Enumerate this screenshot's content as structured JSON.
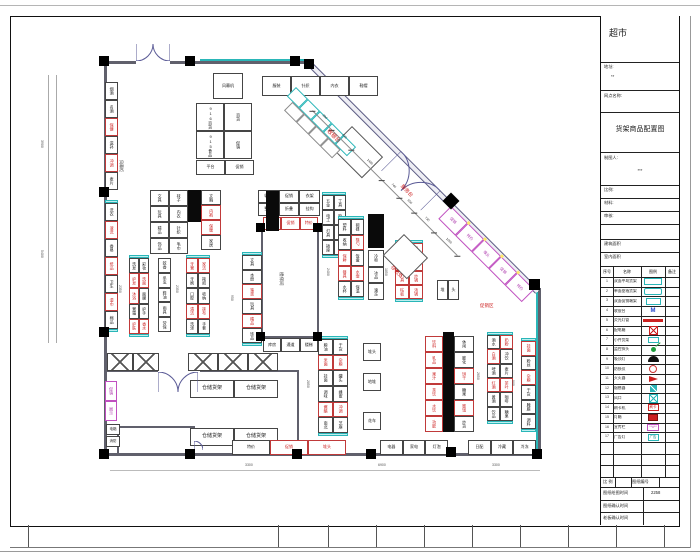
{
  "sheet": {
    "frame": {
      "strip_ticks": [
        28,
        278,
        328,
        376,
        424,
        472,
        520,
        568,
        616,
        664
      ]
    },
    "titleblock": {
      "store_name": "超市",
      "addr_label": "地址:",
      "addr_value": "**",
      "branch_label": "网点名称:",
      "drawing_title": "货架商品配置图",
      "drafter_label": "制图人:",
      "drafter_value": "***",
      "scale_label": "比例:",
      "material_label": "材料:",
      "audit_label": "审核:",
      "area1_label": "建筑面积",
      "area2_label": "室内面积",
      "legend_headers": [
        "序号",
        "名称",
        "图例",
        "备注"
      ],
      "legend_rows": [
        {
          "no": "1",
          "name": "双面中岛货架",
          "sym": "shelf-cyan"
        },
        {
          "no": "2",
          "name": "单面靠墙货架",
          "sym": "shelf-cyan2"
        },
        {
          "no": "3",
          "name": "双面促销端架",
          "sym": "shelf-cyan3"
        },
        {
          "no": "4",
          "name": "收银台",
          "sym": "m-blue",
          "symText": "M"
        },
        {
          "no": "5",
          "name": "荧光灯管",
          "sym": "bar-red"
        },
        {
          "no": "6",
          "name": "配电箱",
          "sym": "box-redx"
        },
        {
          "no": "7",
          "name": "小件货架",
          "sym": "cyan-small"
        },
        {
          "no": "8",
          "name": "监控探头",
          "sym": "green-dot"
        },
        {
          "no": "9",
          "name": "吸顶灯",
          "sym": "black-dome"
        },
        {
          "no": "10",
          "name": "防损仪",
          "sym": "red-ring"
        },
        {
          "no": "11",
          "name": "灭火器",
          "sym": "red-flag"
        },
        {
          "no": "12",
          "name": "烟感器",
          "sym": "teal-box"
        },
        {
          "no": "13",
          "name": "风口",
          "sym": "cyan-x"
        },
        {
          "no": "14",
          "name": "刷卡机",
          "sym": "red-textbox",
          "symText": "刷卡"
        },
        {
          "no": "15",
          "name": "灯箱",
          "sym": "red-fill"
        },
        {
          "no": "16",
          "name": "宣传栏",
          "sym": "magenta-box",
          "symText": "**#**"
        },
        {
          "no": "17",
          "name": "广告灯",
          "sym": "cyan-textbox",
          "symText": "广告"
        },
        {
          "no": "",
          "name": "",
          "sym": ""
        },
        {
          "no": "",
          "name": "",
          "sym": ""
        },
        {
          "no": "",
          "name": "",
          "sym": ""
        }
      ],
      "bottom_rows": {
        "r1a": "比 例",
        "r1b": "图纸编号",
        "r2_label": "图纸绘图时间",
        "r2_value": "2258",
        "r3_label": "图纸确认时间",
        "r4_label": "老板确认时间"
      }
    }
  },
  "plan": {
    "walls": [
      {
        "x": 104,
        "y": 61,
        "w": 32,
        "h": 3
      },
      {
        "x": 170,
        "y": 61,
        "w": 142,
        "h": 3
      },
      {
        "x": 200,
        "y": 59,
        "w": 112,
        "h": 2,
        "c": "#2ab6b8",
        "n": "wall-shelf-line"
      },
      {
        "x": 104,
        "y": 61,
        "w": 3,
        "h": 395
      },
      {
        "x": 104,
        "y": 453,
        "w": 437,
        "h": 3
      },
      {
        "x": 538,
        "y": 288,
        "w": 3,
        "h": 168
      },
      {
        "x": 536,
        "y": 292,
        "w": 2,
        "h": 162,
        "c": "#2ab6b8",
        "n": "wall-shelf-line"
      },
      {
        "x": 104,
        "y": 370,
        "w": 54,
        "h": 2,
        "n": "storage-wall"
      },
      {
        "x": 200,
        "y": 370,
        "w": 99,
        "h": 2,
        "n": "storage-wall"
      },
      {
        "x": 297,
        "y": 370,
        "w": 2,
        "h": 86,
        "n": "storage-wall"
      },
      {
        "x": 117,
        "y": 426,
        "w": 78,
        "h": 2,
        "n": "room-wall"
      },
      {
        "x": 117,
        "y": 426,
        "w": 2,
        "h": 30,
        "n": "room-wall"
      },
      {
        "x": 193,
        "y": 426,
        "w": 2,
        "h": 10,
        "n": "room-wall"
      },
      {
        "x": 261,
        "y": 228,
        "w": 58,
        "h": 2,
        "n": "stair-core-wall"
      },
      {
        "x": 261,
        "y": 228,
        "w": 2,
        "h": 110,
        "n": "stair-core-wall"
      },
      {
        "x": 317,
        "y": 228,
        "w": 2,
        "h": 110,
        "n": "stair-core-wall"
      },
      {
        "x": 261,
        "y": 336,
        "w": 58,
        "h": 2,
        "n": "stair-core-wall"
      },
      {
        "x": 48,
        "y": 75,
        "w": 1,
        "h": 268,
        "c": "#aaa",
        "n": "dim-ext-line"
      },
      {
        "x": 56,
        "y": 75,
        "w": 1,
        "h": 268,
        "c": "#aaa",
        "n": "dim-ext-line"
      },
      {
        "x": 110,
        "y": 470,
        "w": 430,
        "h": 1,
        "c": "#bbb",
        "n": "dim-ext-line"
      }
    ],
    "black_blocks": [
      {
        "x": 266,
        "y": 191,
        "w": 13,
        "h": 40
      },
      {
        "x": 188,
        "y": 190,
        "w": 13,
        "h": 32
      },
      {
        "x": 368,
        "y": 214,
        "w": 16,
        "h": 34
      },
      {
        "x": 443,
        "y": 332,
        "w": 11,
        "h": 100
      }
    ],
    "columns": [
      {
        "x": 99,
        "y": 56
      },
      {
        "x": 185,
        "y": 56
      },
      {
        "x": 290,
        "y": 56
      },
      {
        "x": 304,
        "y": 59
      },
      {
        "x": 99,
        "y": 187
      },
      {
        "x": 99,
        "y": 327
      },
      {
        "x": 99,
        "y": 449
      },
      {
        "x": 185,
        "y": 449
      },
      {
        "x": 292,
        "y": 449
      },
      {
        "x": 366,
        "y": 449
      },
      {
        "x": 446,
        "y": 447
      },
      {
        "x": 532,
        "y": 449
      },
      {
        "x": 256,
        "y": 223,
        "s": 9
      },
      {
        "x": 313,
        "y": 223,
        "s": 9
      },
      {
        "x": 256,
        "y": 332,
        "s": 9
      },
      {
        "x": 313,
        "y": 332,
        "s": 9
      },
      {
        "x": 445,
        "y": 195,
        "s": 12,
        "r": 1
      },
      {
        "x": 529,
        "y": 279,
        "s": 11
      }
    ],
    "doors": [
      {
        "x": 136,
        "y": 44,
        "w": 34,
        "dir": "up"
      },
      {
        "x": 401,
        "y": 151,
        "w": 56,
        "dir": "down",
        "rot": 45
      },
      {
        "x": 158,
        "y": 372,
        "w": 40,
        "dir": "down"
      },
      {
        "x": 194,
        "y": 437,
        "w": 18,
        "dir": "single"
      }
    ],
    "diamonds": [
      {
        "x": 352,
        "y": 126,
        "w": 44,
        "h": 30
      },
      {
        "x": 404,
        "y": 234,
        "w": 34,
        "h": 30
      }
    ],
    "diag_wall": {
      "x": 309,
      "y": 59,
      "len": 326,
      "rot": 45
    },
    "checkout": {
      "x": 296,
      "y": 87,
      "rot": 45
    },
    "magenta_run": {
      "x": 451,
      "y": 206,
      "rot": 45,
      "labels": "促销|特价|堆头|促销|特价"
    },
    "dim_line": {
      "x": 317,
      "y": 106,
      "rot": 45,
      "len": 205,
      "numbers": "890|940|1480|740|650|730|1060"
    },
    "x_units": [
      {
        "x": 107,
        "y": 353,
        "w": 52,
        "h": 18,
        "cols": 2
      },
      {
        "x": 188,
        "y": 353,
        "w": 90,
        "h": 18,
        "cols": 3
      }
    ],
    "gondolas": [
      {
        "n": "entrance-air-curtain",
        "x": 213,
        "y": 73,
        "w": 30,
        "h": 26,
        "cols": 1,
        "rows": 1,
        "labels": "风幕机",
        "fs": 4,
        "dir": "h"
      },
      {
        "n": "wall-shelf-front",
        "x": 262,
        "y": 76,
        "w": 116,
        "h": 20,
        "cols": 4,
        "rows": 1,
        "dir": "h",
        "labels": "服装|针织|内衣|鞋帽"
      },
      {
        "n": "promo-block",
        "x": 196,
        "y": 103,
        "w": 56,
        "h": 56,
        "cols": 2,
        "rows": 2,
        "labels": "916百货|915食品|百货|促销"
      },
      {
        "n": "promo-platform",
        "x": 196,
        "y": 160,
        "w": 58,
        "h": 15,
        "cols": 2,
        "rows": 1,
        "dir": "h",
        "labels": "平台|促销"
      },
      {
        "n": "wall-shelf-left",
        "x": 105,
        "y": 82,
        "w": 13,
        "h": 108,
        "cols": 1,
        "rows": 6,
        "labels": "烟酒|名酒|保健|滋补|冲调|麦片",
        "red": [
          2,
          4
        ]
      },
      {
        "n": "wall-shelf-left",
        "x": 105,
        "y": 200,
        "w": 13,
        "h": 132,
        "cols": 1,
        "rows": 7,
        "cap": true,
        "labels": "洗衣|液洗|香皂|纸品|卫生|湿巾|棉品",
        "red": [
          1,
          3,
          5
        ]
      },
      {
        "n": "gondola",
        "x": 150,
        "y": 190,
        "w": 38,
        "h": 64,
        "cols": 2,
        "rows": 4,
        "labels": "文具|玩具|精品|饰品|袜子|内衣|针织|毛巾"
      },
      {
        "n": "gondola",
        "x": 201,
        "y": 190,
        "w": 20,
        "h": 60,
        "cols": 1,
        "rows": 4,
        "labels": "文胸|内裤|保暖|家居",
        "red": [
          1,
          2
        ]
      },
      {
        "n": "gondola",
        "x": 129,
        "y": 255,
        "w": 20,
        "h": 82,
        "cols": 2,
        "rows": 5,
        "cap": true,
        "labels": "洗发|护发|沐浴|膏霜|护肤|彩妆|洗面|面膜|护手|香水",
        "red": [
          1,
          2,
          4,
          6,
          9
        ]
      },
      {
        "n": "gondola",
        "x": 158,
        "y": 258,
        "w": 13,
        "h": 74,
        "cols": 1,
        "rows": 5,
        "labels": "蚊香|杀虫|鞋油|雨具|劳保"
      },
      {
        "n": "gondola",
        "x": 186,
        "y": 255,
        "w": 24,
        "h": 82,
        "cols": 2,
        "rows": 5,
        "cap": true,
        "labels": "牙膏|牙刷|口腔|清洁|洗涤|家洁|拖把|收纳|抹布|手套",
        "red": [
          0,
          3,
          5,
          8
        ]
      },
      {
        "n": "gondola",
        "x": 242,
        "y": 252,
        "w": 20,
        "h": 94,
        "cols": 1,
        "rows": 6,
        "cap": true,
        "labels": "文具|本册|笔类|玩具|精品|饰品",
        "red": [
          2,
          4
        ]
      },
      {
        "n": "end-cap-shelf",
        "x": 263,
        "y": 217,
        "w": 55,
        "h": 13,
        "cols": 3,
        "rows": 1,
        "dir": "h",
        "labels": "端架|促销|特价",
        "red": [
          0,
          1,
          2
        ]
      },
      {
        "n": "gondola",
        "x": 258,
        "y": 190,
        "w": 62,
        "h": 26,
        "cols": 3,
        "rows": 2,
        "dir": "h",
        "labels": "收纳|整理|促销|折叠|衣架|挂钩"
      },
      {
        "n": "end-cap-shelf",
        "x": 263,
        "y": 338,
        "w": 55,
        "h": 14,
        "cols": 3,
        "rows": 1,
        "dir": "h",
        "labels": "库房|通道|楼梯"
      },
      {
        "n": "gondola",
        "x": 322,
        "y": 192,
        "w": 24,
        "h": 66,
        "cols": 2,
        "rows": 4,
        "cap": true,
        "labels": "五金|电工|灯具|插座|工具|胶带|电池|线材"
      },
      {
        "n": "gondola",
        "x": 338,
        "y": 216,
        "w": 26,
        "h": 84,
        "cols": 2,
        "rows": 5,
        "cap": true,
        "labels": "塑料|收纳|保鲜|餐具|水杯|碗碟|筷勺|饭盒|水壶|保温",
        "red": [
          2,
          3,
          6,
          8
        ]
      },
      {
        "n": "freezer-run",
        "x": 368,
        "y": 250,
        "w": 16,
        "h": 50,
        "cols": 1,
        "rows": 3,
        "labels": "冷柜|冰品|速冻"
      },
      {
        "n": "gondola",
        "x": 395,
        "y": 240,
        "w": 28,
        "h": 62,
        "cols": 2,
        "rows": 4,
        "cap": true,
        "labels": "锅具|厨杂|刀具|砧板|炊具|蒸锅|炒锅|汤锅",
        "red": [
          0,
          1,
          2,
          3,
          4,
          5,
          6,
          7
        ]
      },
      {
        "n": "promo-table",
        "x": 437,
        "y": 280,
        "w": 22,
        "h": 20,
        "cols": 2,
        "rows": 1,
        "dir": "h",
        "labels": "堆|头"
      },
      {
        "n": "gondola",
        "x": 318,
        "y": 336,
        "w": 30,
        "h": 100,
        "cols": 2,
        "rows": 6,
        "cap": true,
        "labels": "粮油|米面|挂面|调味|酱醋|南北|干货|杂粮|罐头|蜂蜜|冲调|芝麻",
        "red": [
          1,
          4,
          7,
          10
        ]
      },
      {
        "n": "gondola",
        "x": 425,
        "y": 336,
        "w": 18,
        "h": 96,
        "cols": 1,
        "rows": 6,
        "labels": "饮料|乳品|果汁|茶饮|水饮|功能",
        "red": [
          0,
          1,
          2,
          3,
          4,
          5
        ]
      },
      {
        "n": "gondola",
        "x": 454,
        "y": 336,
        "w": 20,
        "h": 96,
        "cols": 1,
        "rows": 6,
        "labels": "休闲|膨化|饼干|糖果|蜜饯|炒货",
        "red": [
          2,
          4
        ]
      },
      {
        "n": "gondola",
        "x": 487,
        "y": 332,
        "w": 26,
        "h": 92,
        "cols": 2,
        "rows": 6,
        "cap": true,
        "labels": "酒水|白酒|啤酒|红酒|黄酒|饮品|奶粉|冲饮|麦片|茶叶|咖啡|糖果",
        "red": [
          1,
          3,
          6,
          9
        ]
      },
      {
        "n": "wall-shelf-right",
        "x": 521,
        "y": 338,
        "w": 15,
        "h": 94,
        "cols": 1,
        "rows": 6,
        "cap": true,
        "labels": "挂面|粉丝|杂粮|干货|腌腊|调料",
        "red": [
          0,
          2
        ]
      },
      {
        "n": "promo-table",
        "x": 363,
        "y": 343,
        "w": 18,
        "h": 18,
        "cols": 1,
        "rows": 1,
        "dir": "h",
        "labels": "堆头"
      },
      {
        "n": "promo-table",
        "x": 363,
        "y": 373,
        "w": 18,
        "h": 18,
        "cols": 1,
        "rows": 1,
        "dir": "h",
        "labels": "地堆"
      },
      {
        "n": "promo-table",
        "x": 363,
        "y": 412,
        "w": 18,
        "h": 18,
        "cols": 1,
        "rows": 1,
        "dir": "h",
        "labels": "花车"
      },
      {
        "n": "storage-rack",
        "x": 190,
        "y": 380,
        "w": 88,
        "h": 18,
        "cols": 2,
        "rows": 1,
        "dir": "h",
        "labels": "仓储货架|仓储货架",
        "fs": 5
      },
      {
        "n": "storage-rack",
        "x": 190,
        "y": 428,
        "w": 88,
        "h": 18,
        "cols": 2,
        "rows": 1,
        "dir": "h",
        "labels": "仓储货架|仓储货架",
        "fs": 5
      },
      {
        "n": "wall-shelf-bottom",
        "x": 232,
        "y": 440,
        "w": 114,
        "h": 15,
        "cols": 3,
        "rows": 1,
        "dir": "h",
        "labels": "特价|促销|堆头",
        "red": [
          1,
          2
        ]
      },
      {
        "n": "wall-shelf-bottom",
        "x": 380,
        "y": 440,
        "w": 68,
        "h": 15,
        "cols": 3,
        "rows": 1,
        "dir": "h",
        "labels": "电器|家电|灯泡"
      },
      {
        "n": "wall-shelf-bottom",
        "x": 468,
        "y": 440,
        "w": 68,
        "h": 15,
        "cols": 3,
        "rows": 1,
        "dir": "h",
        "labels": "日配|冷藏|冷冻"
      },
      {
        "n": "display-shelf",
        "x": 105,
        "y": 381,
        "w": 12,
        "h": 40,
        "cols": 1,
        "rows": 2,
        "labels": "促销|展示",
        "mag": true
      },
      {
        "n": "utility-box",
        "x": 106,
        "y": 424,
        "w": 14,
        "h": 11,
        "cols": 1,
        "rows": 1,
        "dir": "h",
        "labels": "电箱",
        "fs": 3.5
      },
      {
        "n": "utility-box",
        "x": 106,
        "y": 436,
        "w": 14,
        "h": 11,
        "cols": 1,
        "rows": 1,
        "dir": "h",
        "labels": "消防",
        "fs": 3.5
      }
    ],
    "texts": [
      {
        "t": "收银台",
        "x": 331,
        "y": 127,
        "c": "#cc2020",
        "r": 45,
        "s": 5.5,
        "n": "cashier-label"
      },
      {
        "t": "服务台",
        "x": 404,
        "y": 183,
        "c": "#cc2020",
        "r": 45,
        "s": 5,
        "n": "service-desk-label"
      },
      {
        "t": "存包处",
        "x": 394,
        "y": 264,
        "c": "#cc2020",
        "r": 45,
        "s": 5,
        "n": "bag-storage-label"
      },
      {
        "t": "促销区",
        "x": 480,
        "y": 303,
        "c": "#cc2020",
        "r": 0,
        "s": 4.5,
        "n": "promo-zone-label"
      },
      {
        "t": "风幕柜",
        "x": 124,
        "y": 160,
        "c": "#333",
        "r": 90,
        "s": 4,
        "n": "cooler-label"
      },
      {
        "t": "楼梯间",
        "x": 284,
        "y": 272,
        "c": "#555",
        "r": 90,
        "s": 4.5,
        "n": "stair-label"
      }
    ],
    "dims": [
      {
        "t": "3900",
        "x": 44,
        "y": 140,
        "r": 90
      },
      {
        "t": "5400",
        "x": 44,
        "y": 250,
        "r": 90
      },
      {
        "t": "2350",
        "x": 122,
        "y": 285,
        "r": 90
      },
      {
        "t": "2350",
        "x": 179,
        "y": 285,
        "r": 90
      },
      {
        "t": "950",
        "x": 234,
        "y": 295,
        "r": 90
      },
      {
        "t": "2400",
        "x": 330,
        "y": 268,
        "r": 90
      },
      {
        "t": "1850",
        "x": 388,
        "y": 268,
        "r": 90
      },
      {
        "t": "2850",
        "x": 310,
        "y": 380,
        "r": 90
      },
      {
        "t": "2650",
        "x": 480,
        "y": 372,
        "r": 90
      },
      {
        "t": "900",
        "x": 515,
        "y": 380,
        "r": 90
      },
      {
        "t": "3300",
        "x": 245,
        "y": 463,
        "r": 0
      },
      {
        "t": "6900",
        "x": 378,
        "y": 463,
        "r": 0
      },
      {
        "t": "3300",
        "x": 492,
        "y": 463,
        "r": 0
      }
    ]
  }
}
